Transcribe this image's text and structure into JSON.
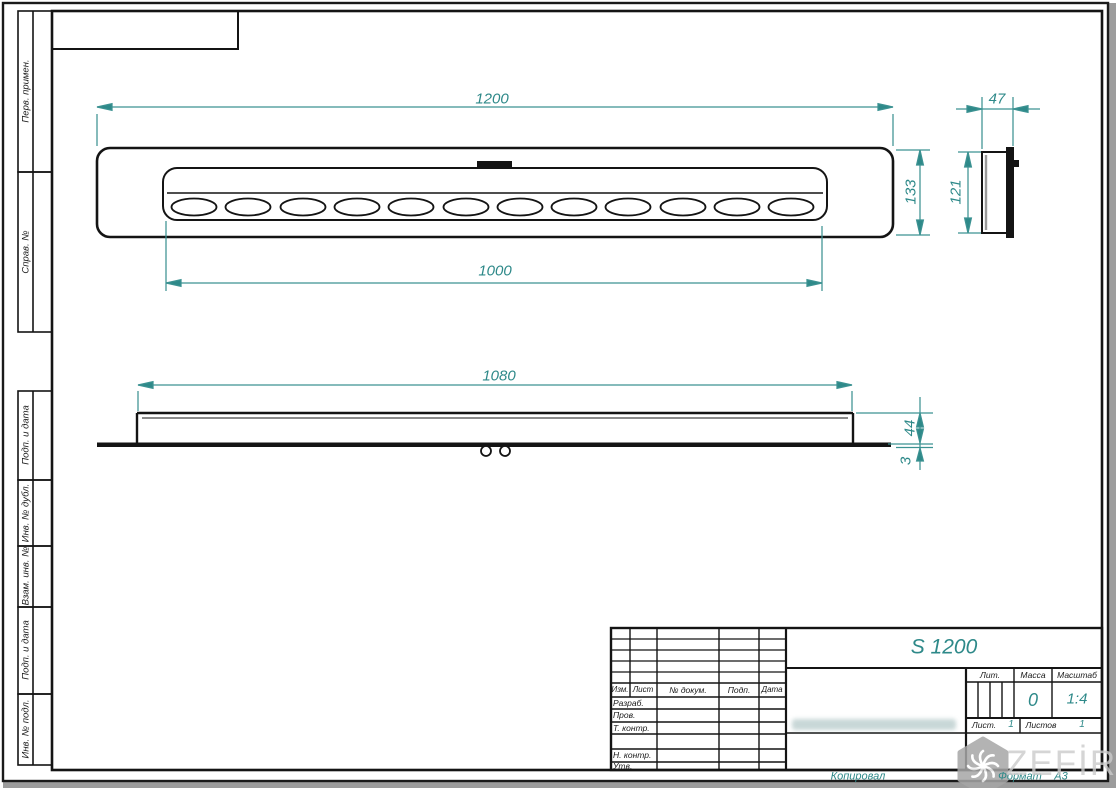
{
  "colors": {
    "dimension_accent": "#2e8989",
    "dimension_line": "#3c9292",
    "drawing_ink": "#141414",
    "watermark_gray": "#a6a6a6"
  },
  "dimensions": {
    "top_view": {
      "overall_length": "1200",
      "slot_row_length": "1000",
      "overall_width": "133"
    },
    "end_view": {
      "depth": "47",
      "height": "121"
    },
    "side_view": {
      "mount_length": "1080",
      "body_height": "44",
      "flange_thickness": "3"
    }
  },
  "margin_column": {
    "items": [
      {
        "label": "Перв. примен."
      },
      {
        "label": "Справ. №"
      },
      {
        "label": "Подп. и дата"
      },
      {
        "label": "Инв. № дубл."
      },
      {
        "label": "Взам. инв. №"
      },
      {
        "label": "Подп. и дата"
      },
      {
        "label": "Инв. № подл."
      }
    ]
  },
  "title_block": {
    "designation": "S 1200",
    "revision_header": {
      "izm": "Изм.",
      "list": "Лист",
      "doc": "№ докум.",
      "sign": "Подп.",
      "date": "Дата"
    },
    "signature_rows": [
      {
        "label": "Разраб."
      },
      {
        "label": "Пров."
      },
      {
        "label": "Т. контр."
      },
      {
        "label": "Н. контр."
      },
      {
        "label": "Утв."
      }
    ],
    "lit_label": "Лит.",
    "mass_label": "Масса",
    "mass_value": "0",
    "scale_label": "Масштаб",
    "scale_value": "1:4",
    "sheet_label": "Лист.",
    "sheet_value": "1",
    "sheets_label": "Листов",
    "sheets_value": "1"
  },
  "footer": {
    "copied": "Копировал",
    "format_label": "Формат",
    "format_value": "А3"
  },
  "watermark": {
    "brand": "ZEFİRE"
  }
}
